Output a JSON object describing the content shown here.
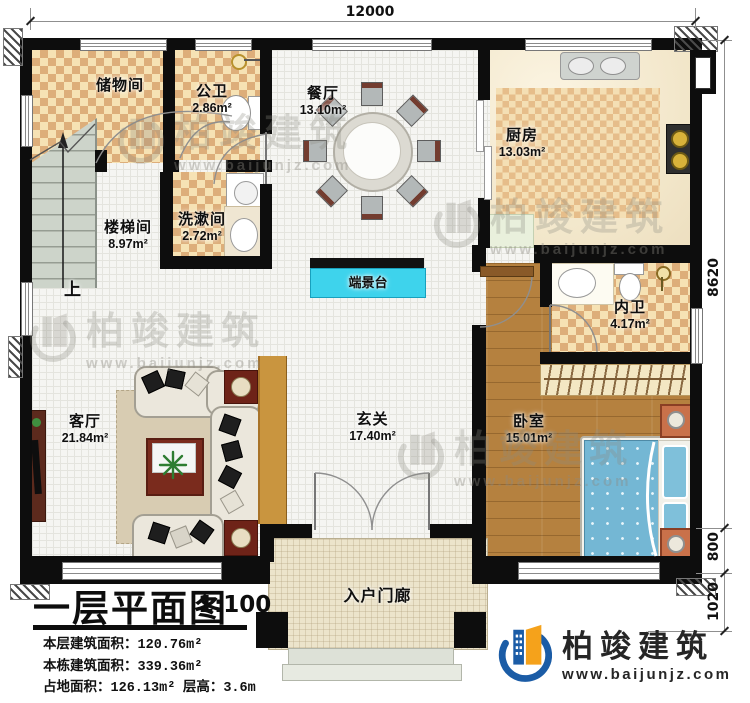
{
  "plan": {
    "dimensions": {
      "top_width": "12000",
      "right_height": "8620",
      "right_lower": "800",
      "right_bottom": "1020"
    },
    "rooms": {
      "storage": {
        "name": "储物间",
        "area": ""
      },
      "public_bath": {
        "name": "公卫",
        "area": "2.86m²"
      },
      "dining": {
        "name": "餐厅",
        "area": "13.10m²"
      },
      "kitchen": {
        "name": "厨房",
        "area": "13.03m²"
      },
      "stairwell": {
        "name": "楼梯间",
        "area": "8.97m²"
      },
      "washroom": {
        "name": "洗漱间",
        "area": "2.72m²"
      },
      "console": {
        "name": "端景台",
        "area": ""
      },
      "inner_bath": {
        "name": "内卫",
        "area": "4.17m²"
      },
      "living": {
        "name": "客厅",
        "area": "21.84m²"
      },
      "foyer": {
        "name": "玄关",
        "area": "17.40m²"
      },
      "bedroom": {
        "name": "卧室",
        "area": "15.01m²"
      },
      "porch": {
        "name": "入户门廊",
        "area": ""
      }
    },
    "stairs_up_label": "上"
  },
  "title_block": {
    "title": "一层平面图",
    "scale": "1:100",
    "stats": [
      {
        "label": "本层建筑面积：",
        "value": "120.76m²"
      },
      {
        "label": "本栋建筑面积：",
        "value": "339.36m²"
      },
      {
        "label": "占地面积：",
        "value": "126.13m²",
        "label2": "层高：",
        "value2": "3.6m"
      }
    ]
  },
  "brand": {
    "name": "柏竣建筑",
    "url": "www.baijunjz.com"
  },
  "watermark": {
    "name": "柏竣建筑",
    "url": "www.baijunjz.com"
  },
  "colors": {
    "accent_cyan": "#3ed3ec",
    "logo_blue": "#1b5ca6",
    "logo_orange": "#f5a21b",
    "wall": "#0d0d0d"
  }
}
